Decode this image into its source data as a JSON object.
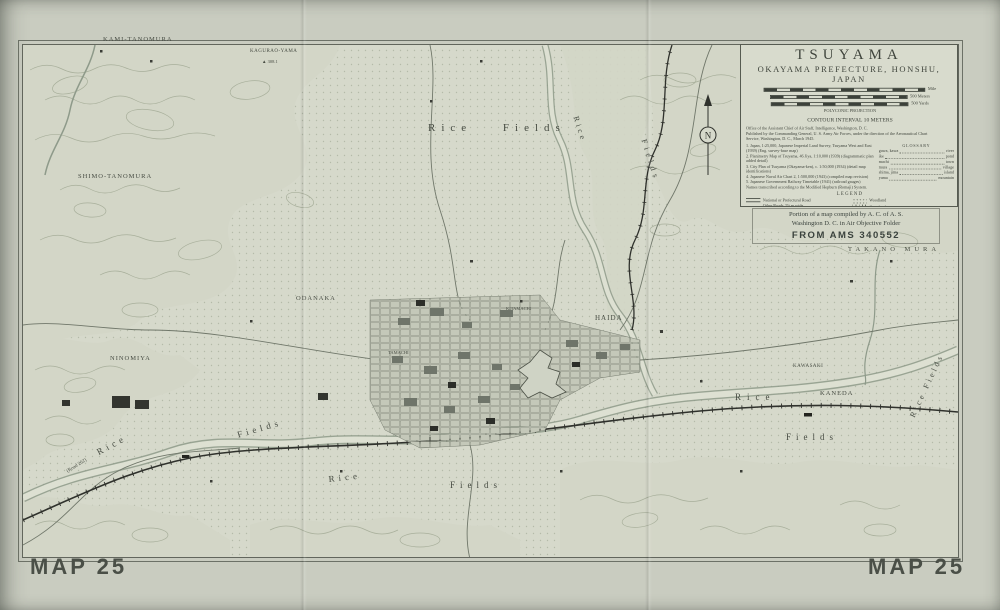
{
  "page": {
    "map_number": "MAP 25"
  },
  "colors": {
    "paper": "#c9ccc0",
    "sheet": "#d6d9cb",
    "ink": "#474c43",
    "black_features": "#2e302b",
    "dense_swatch": "#c08d85",
    "sparse_swatch": "#e0c4bb"
  },
  "compass": {
    "north": "N"
  },
  "title_block": {
    "title": "TSUYAMA",
    "subtitle": "OKAYAMA PREFECTURE, HONSHU, JAPAN",
    "scale": {
      "row1_label": "Mile",
      "row2_label": "500 Meters",
      "row3_label": "500 Yards"
    },
    "projection": "POLYCONIC PROJECTION",
    "contour_interval": "CONTOUR INTERVAL 10 METERS",
    "credits": [
      "Office of the Assistant Chief of Air Staff, Intelligence, Washington, D. C.",
      "Published by the Commanding General, U. S. Army Air Forces, under the direction of the Aeronautical Chart",
      "Service, Washington, D. C., March 1945."
    ],
    "sources": [
      "1. Japan, 1:25,000, Japanese Imperial Land Survey, Tsuyama West and East (1939) (Eng. survey-base map)",
      "2. Planimetry Map of Tsuyama, 46 Jiya, 1:10,000 (1939) (diagrammatic plan added detail)",
      "3. City Plan of Tsuyama (Okayama-ken), c. 1:50,000 (1934) (detail map identifications)",
      "4. Japanese Naval Air Chart 2, 1:500,000 (1943) (compiled map revision)",
      "5. Japanese Government Railway Timetable (1941) (railroad gauges)",
      "Names transcribed according to the Modified Hepburn (Romaji) System."
    ],
    "glossary": {
      "heading": "GLOSSARY",
      "entries": [
        {
          "jp": "gawa, kawa",
          "en": "river"
        },
        {
          "jp": "ike",
          "en": "pond"
        },
        {
          "jp": "machi",
          "en": "town"
        },
        {
          "jp": "mura",
          "en": "village"
        },
        {
          "jp": "shima, jima",
          "en": "island"
        },
        {
          "jp": "yama",
          "en": "mountain"
        }
      ]
    },
    "legend": {
      "heading": "LEGEND",
      "left": [
        {
          "label": "National or Prefectural Road"
        },
        {
          "label": "Other Roads 2½ m wide"
        },
        {
          "label": "Roads, Tracks or Trails less than 2½ m wide"
        },
        {
          "label": "3'6\" Gauge Single Track Railroad"
        },
        {
          "label": "High Tension Power Line"
        },
        {
          "label": "Railroad Station"
        }
      ],
      "right": [
        {
          "label": "Woodland"
        },
        {
          "label": "Grassland"
        },
        {
          "label": "Rice Fields"
        },
        {
          "label": "Densely Built-up Area"
        },
        {
          "label": "Sparsely Built-up Area"
        }
      ]
    },
    "heights_note": "HEIGHTS AND DEPTHS IN METERS"
  },
  "stamp": {
    "line1": "Portion of a map compiled by A. C. of A. S.",
    "line2": "Washington D. C. in Air Objective Folder",
    "line3": "FROM AMS 340552"
  },
  "labels": {
    "kami_tanomura": "KAMI-TANOMURA",
    "kagurao_yama": "KAGURAO-YAMA",
    "kagurao_elev": "▲ 308.1",
    "shimo_tanomura": "SHIMO-TANOMURA",
    "rice_fields_top": "Rice Fields",
    "rice_kamo": "Rice",
    "fields_kamo": "Fields",
    "odanaka": "ODANAKA",
    "haida": "HAIDA",
    "takano_mura": "TAKANO MURA",
    "ninomiya": "NINOMIYA",
    "kawasaki": "KAWASAKI",
    "kaneda": "KANEDA",
    "rice_east": "Rice",
    "fields_east": "Fields",
    "rice_sw": "Rice",
    "fields_sw": "Fields",
    "rice_s": "Rice",
    "fields_s": "Fields",
    "rice_fields_right": "Rice Fields",
    "road_262": "(Road 262)",
    "kitamachi": "KITAMACHI",
    "tamachi": "TAMACHI"
  }
}
